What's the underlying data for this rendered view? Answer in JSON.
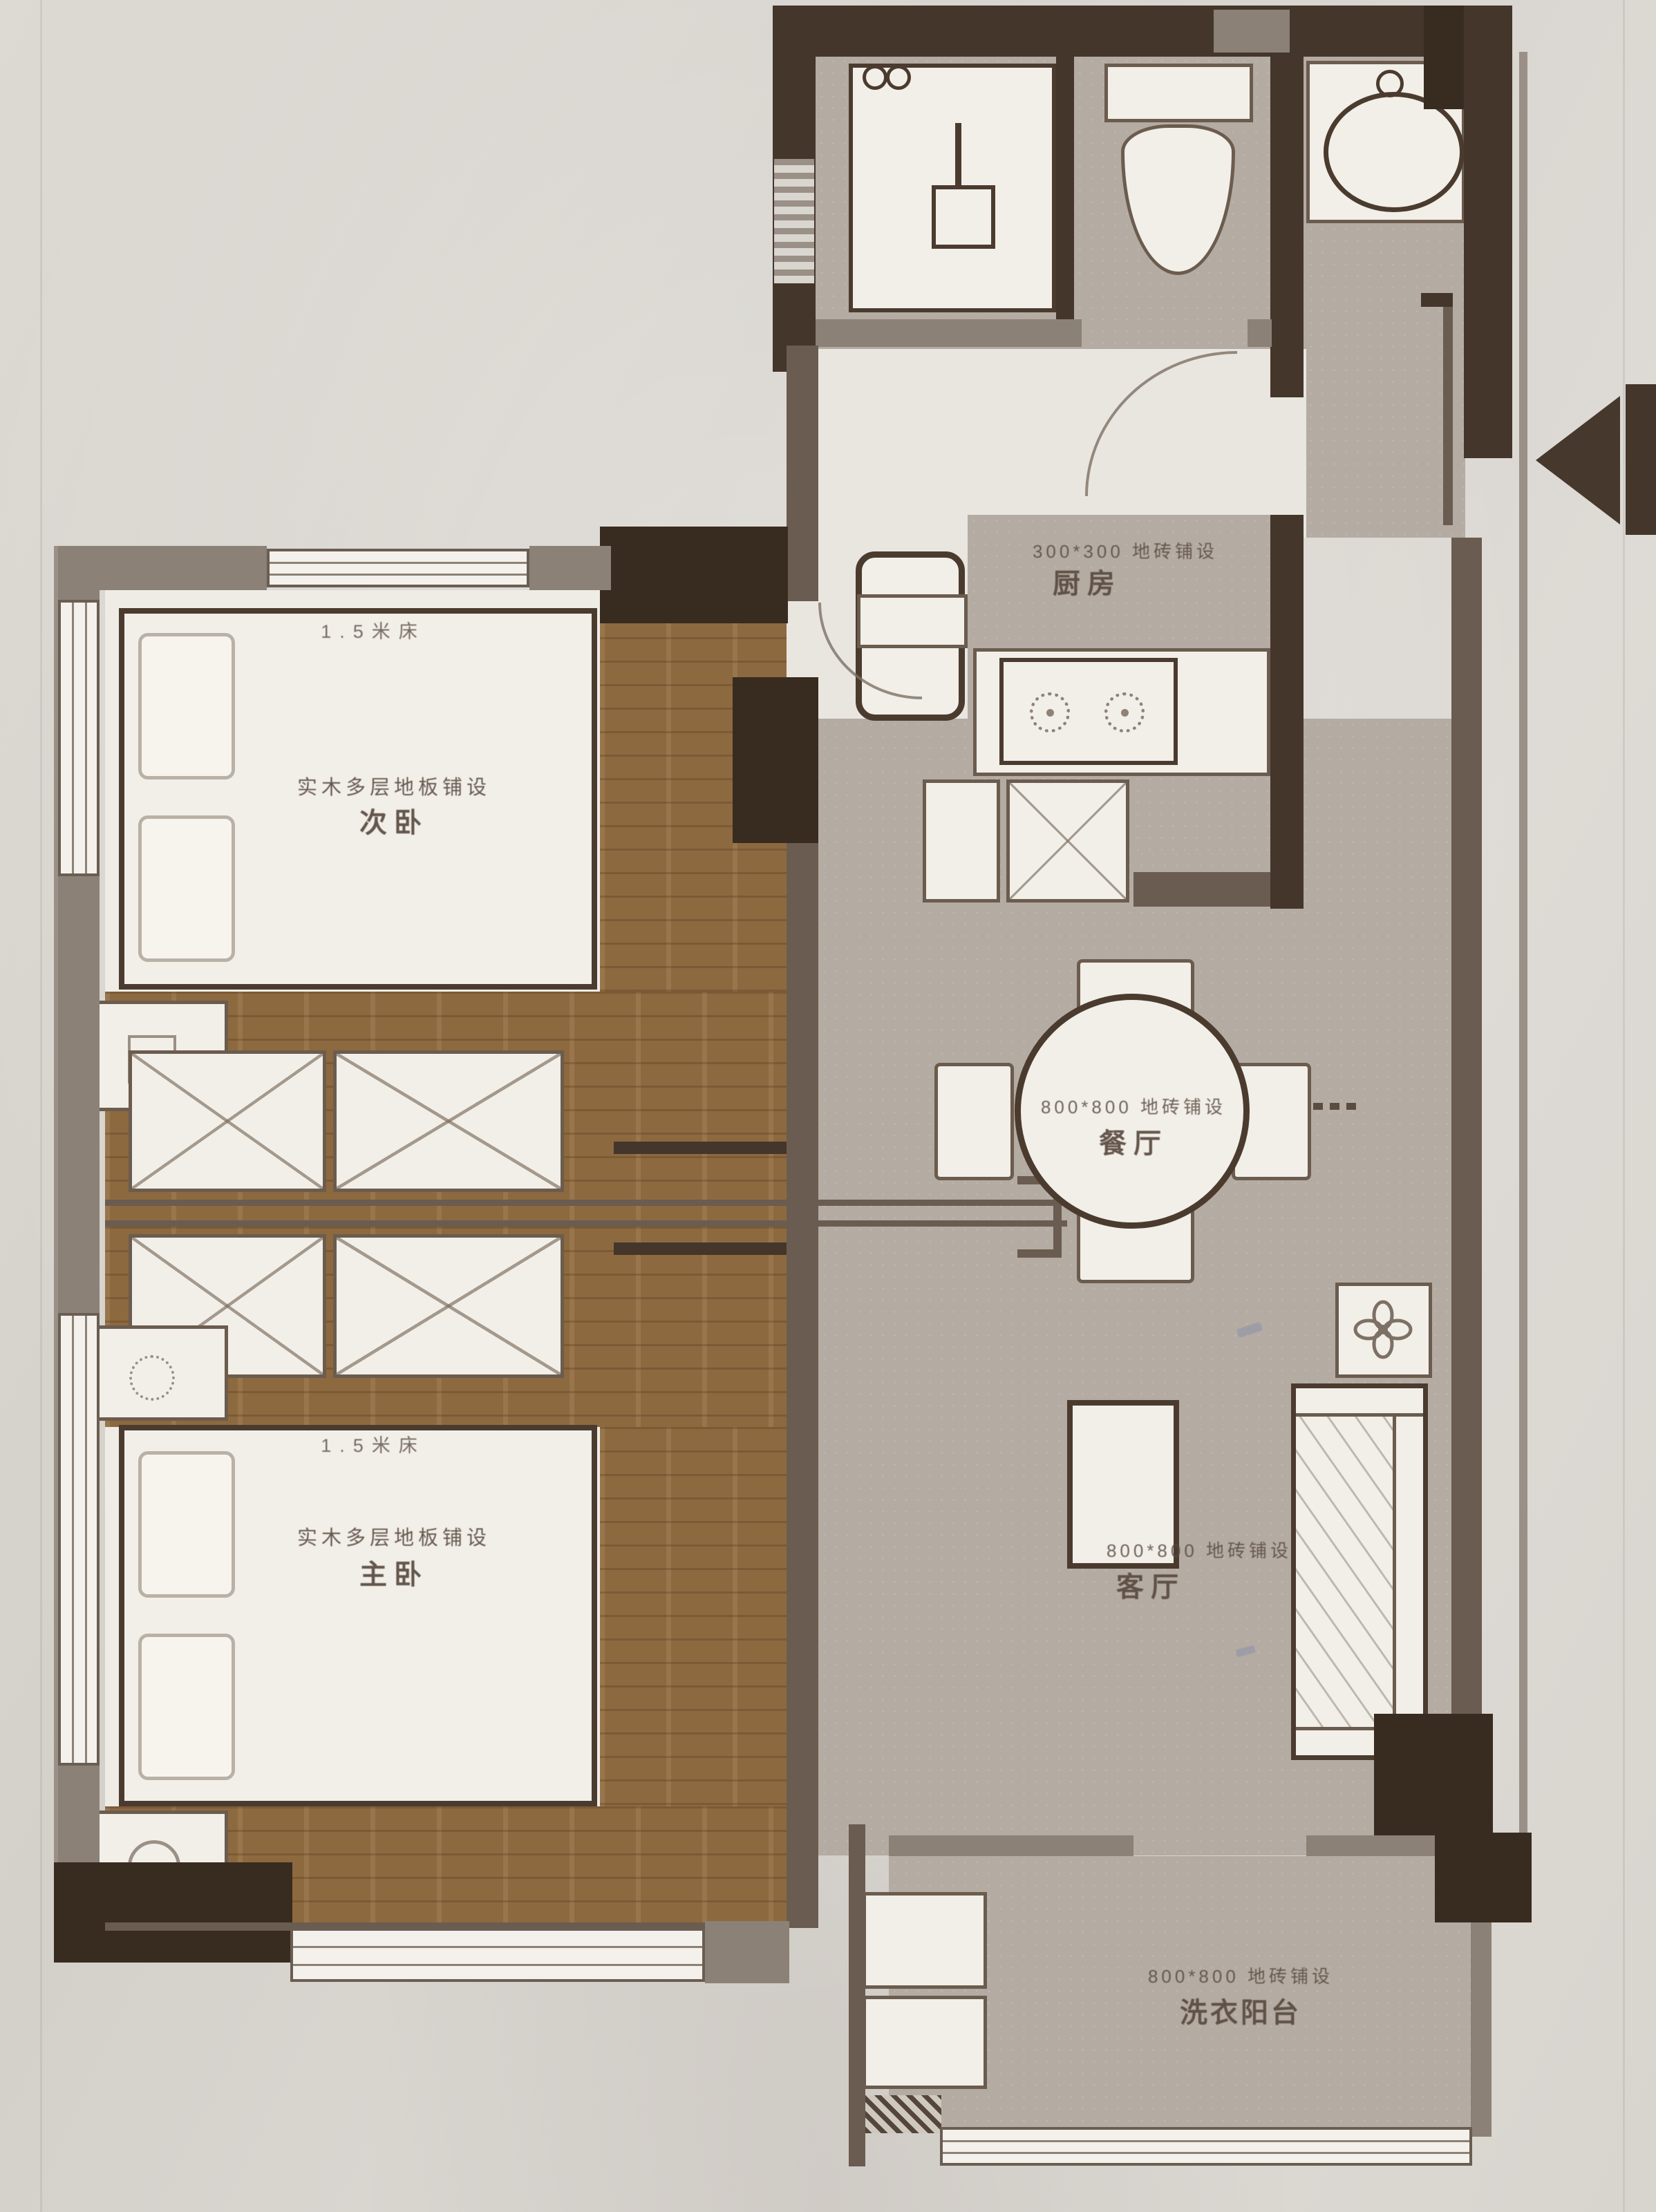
{
  "title": "两室户型平面图",
  "rooms": {
    "kitchen": {
      "floor_note": "300*300 地砖铺设",
      "name": "厨房"
    },
    "secondary_bedroom": {
      "bed_size": "1.5米床",
      "floor_note": "实木多层地板铺设",
      "name": "次卧"
    },
    "master_bedroom": {
      "bed_size": "1.5米床",
      "floor_note": "实木多层地板铺设",
      "name": "主卧"
    },
    "dining": {
      "floor_note": "800*800 地砖铺设",
      "name": "餐厅"
    },
    "living": {
      "floor_note": "800*800 地砖铺设",
      "name": "客厅"
    },
    "laundry_balcony": {
      "floor_note": "800*800 地砖铺设",
      "name": "洗衣阳台"
    }
  },
  "icons": {
    "entry_arrow": "left-pointing entry triangle with bar",
    "shower_head": "square shower head on stem",
    "toilet": "tank + oval bowl",
    "sink": "oval basin with faucet",
    "stove_burner": "dotted circle with center dot",
    "plant_flower": "four-petal flower",
    "wardrobe_x": "crossed diagonals",
    "window": "triple-line band"
  },
  "colors": {
    "wall_dark": "#44362a",
    "wall_gray": "#8b8176",
    "tile_floor": "#b4aba3",
    "wood_floor": "#8d6940",
    "room_floor": "#efece6",
    "furniture": "#f2efe9",
    "paper": "#d8d4ce",
    "label_text": "#584a3f"
  }
}
